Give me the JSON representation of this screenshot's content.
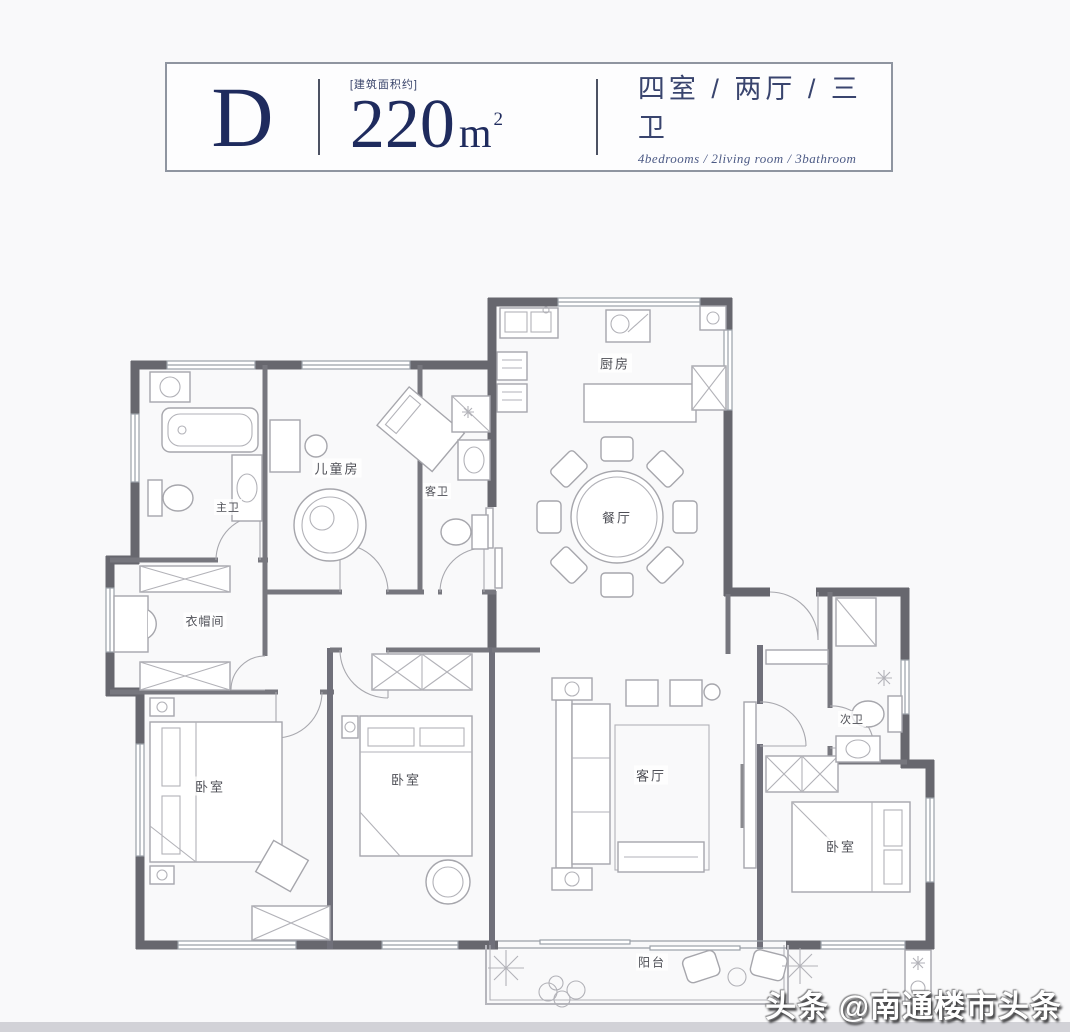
{
  "title_card": {
    "unit_label": "D",
    "area_prefix": "[建筑面积约]",
    "area_number": "220",
    "area_unit": "m",
    "area_exponent": "2",
    "layout_cn": "四室 / 两厅 / 三卫",
    "layout_en": "4bedrooms / 2living room / 3bathroom"
  },
  "rooms": {
    "kitchen": {
      "label": "厨房"
    },
    "dining": {
      "label": "餐厅"
    },
    "kids_room": {
      "label": "儿童房"
    },
    "master_bath": {
      "label": "主卫"
    },
    "guest_bath": {
      "label": "客卫"
    },
    "cloakroom": {
      "label": "衣帽间"
    },
    "bedroom_left": {
      "label": "卧室"
    },
    "bedroom_middle": {
      "label": "卧室"
    },
    "living_room": {
      "label": "客厅"
    },
    "bedroom_right": {
      "label": "卧室"
    },
    "second_bath": {
      "label": "次卫"
    },
    "balcony": {
      "label": "阳台"
    }
  },
  "watermark": {
    "text": "头条 @南通楼市头条"
  },
  "colors": {
    "accent_navy": "#1f2b5e",
    "wall_gray": "#67676e",
    "line_gray": "#9aa0a8",
    "background": "#f9f9fa"
  }
}
